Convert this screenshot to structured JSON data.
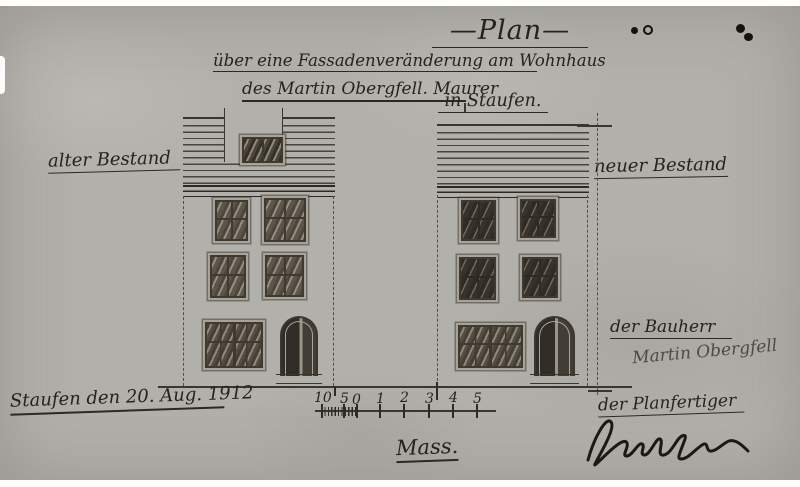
{
  "page": {
    "title": "—Plan—",
    "subtitle1": "über eine Fassadenveränderung am Wohnhaus",
    "subtitle2": "des Martin Obergfell. Maurer",
    "location": "in Staufen.",
    "label_old": "alter Bestand",
    "label_new": "neuer Bestand",
    "date_place": "Staufen den 20. Aug. 1912",
    "client_label": "der Bauherr",
    "client_signature": "Martin Obergfell",
    "draftsman_label": "der Planfertiger",
    "scale_caption": "Mass.",
    "scale_ticks": [
      "10",
      "5",
      "0",
      "1",
      "2",
      "3",
      "4",
      "5"
    ],
    "colors": {
      "paper": "#b2b0ab",
      "ink": "#26221d"
    },
    "icons": {
      "ink_dots": "ink-blot-dots",
      "draftsman_signature": "signature-scribble"
    }
  }
}
